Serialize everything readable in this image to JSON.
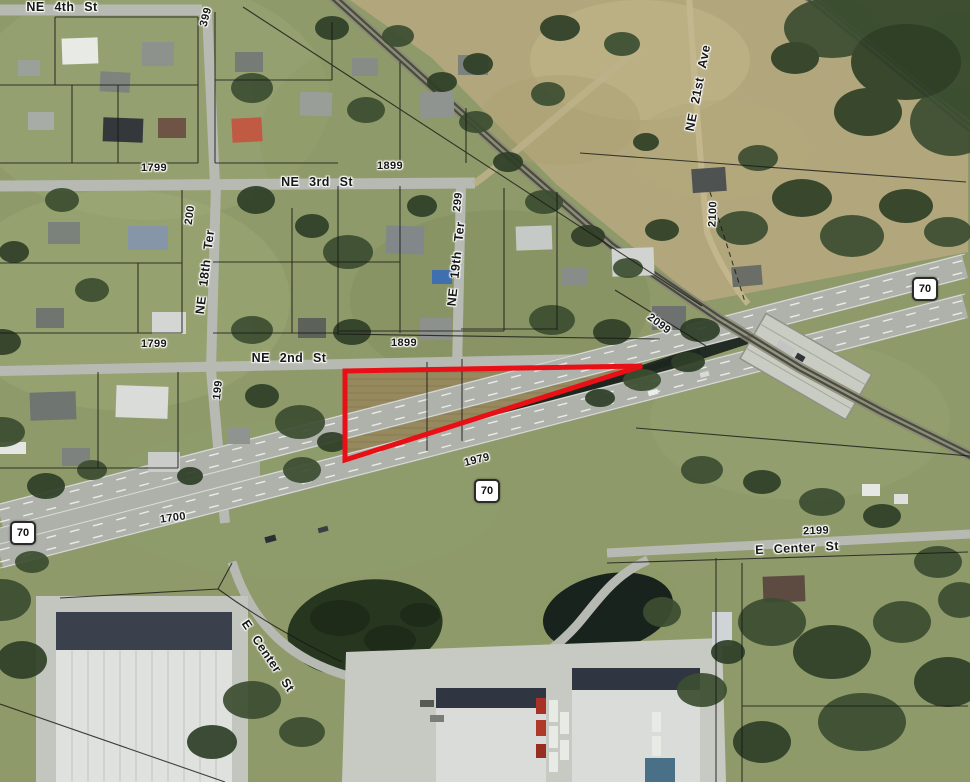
{
  "map": {
    "imagery": "aerial",
    "colors": {
      "highlight_outline": "#e81016",
      "parcel_line": "#161616",
      "label_text": "#171717",
      "label_halo": "#ffffff",
      "route_shield_bg": "#ffffff",
      "route_shield_border": "#2a2a2a"
    },
    "highlighted_parcel": {
      "points": "345,371 642,366 345,460"
    },
    "route_shields": [
      {
        "label": "70"
      },
      {
        "label": "70"
      },
      {
        "label": "70"
      }
    ],
    "street_labels": [
      {
        "text": "NE 4th St"
      },
      {
        "text": "NE 3rd St"
      },
      {
        "text": "NE 2nd St"
      },
      {
        "text": "NE 18th Ter"
      },
      {
        "text": "NE 19th Ter"
      },
      {
        "text": "NE 21st Ave"
      },
      {
        "text": "E Center St"
      },
      {
        "text": "E Center St"
      }
    ],
    "block_number_labels": [
      {
        "text": "399"
      },
      {
        "text": "1799"
      },
      {
        "text": "1899"
      },
      {
        "text": "200"
      },
      {
        "text": "299"
      },
      {
        "text": "2100"
      },
      {
        "text": "199"
      },
      {
        "text": "1799"
      },
      {
        "text": "1899"
      },
      {
        "text": "2099"
      },
      {
        "text": "1979"
      },
      {
        "text": "1700"
      },
      {
        "text": "2199"
      }
    ]
  }
}
